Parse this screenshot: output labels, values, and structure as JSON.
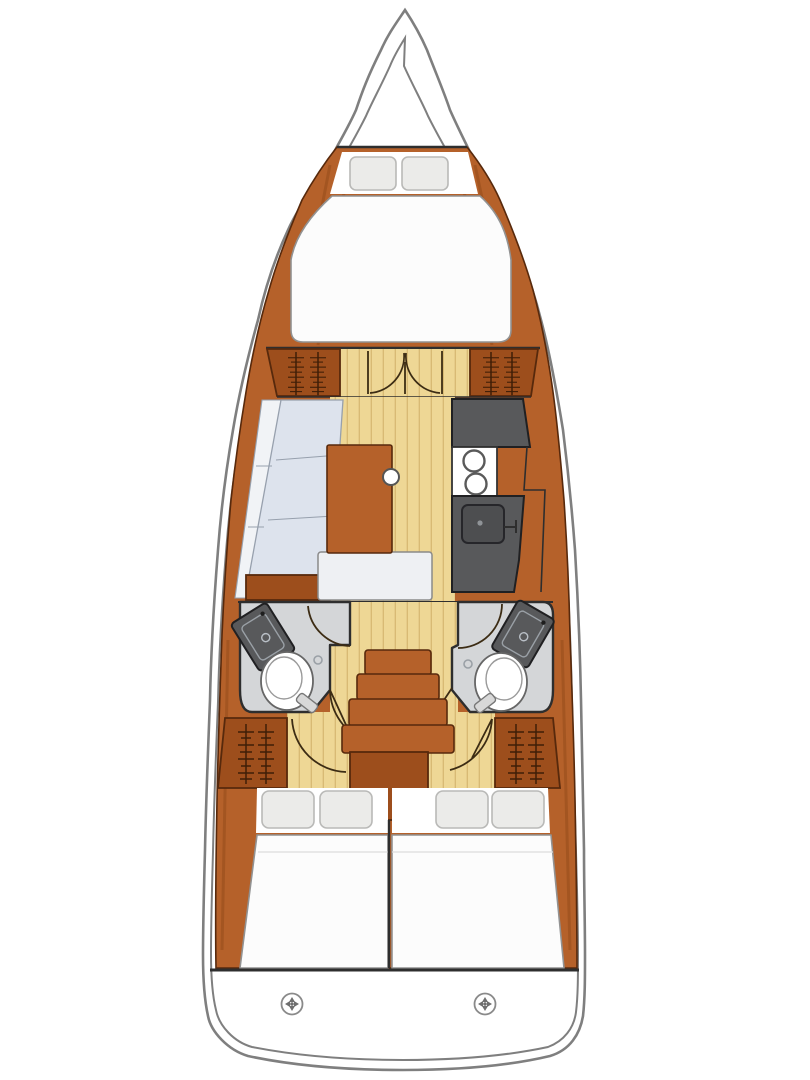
{
  "diagram": {
    "type": "sailboat-interior-floor-plan",
    "orientation": "bow-up",
    "regions": [
      "foredeck",
      "forward-cabin",
      "forward-v-berth",
      "forward-hanging-lockers",
      "forward-cabin-double-doors",
      "saloon",
      "port-settee",
      "saloon-table",
      "nav-seat",
      "galley",
      "galley-worktop",
      "stove",
      "galley-sink",
      "port-head",
      "starboard-head",
      "companionway-steps",
      "engine-compartment",
      "aft-hanging-lockers",
      "aft-cabin-port",
      "aft-cabin-starboard",
      "transom",
      "deck-fittings"
    ],
    "symbols": {
      "hanger_rod": "clothes-rod-with-hangers",
      "door_swing": "quarter-circle-arc",
      "deck_fitting": "circled-cross-cap",
      "burner": "circle",
      "toilet": "oval-bowl",
      "washbasin": "tilted-dark-rectangle"
    },
    "counts": {
      "cabins": 3,
      "heads": 2,
      "forward_pillows": 2,
      "aft_pillows_port": 2,
      "aft_pillows_starboard": 2,
      "stove_burners": 2,
      "companionway_steps": 4,
      "deck_fittings": 2
    }
  },
  "colors": {
    "hull_line": "#7f7f7f",
    "interior_line": "#2e2e2e",
    "wood": "#b5612a",
    "wood_dark": "#9d4e1c",
    "wood_edge": "#57290c",
    "wood_streak": "#8a4315",
    "hanger": "#3f1e07",
    "door_line": "#3c2c14",
    "floor": "#eed795",
    "floor_line": "#d8ba74",
    "berth": "#fcfcfc",
    "berth_line": "#929292",
    "pillow": "#ebebe9",
    "pillow_line": "#b9b9b7",
    "settee": "#dde3ed",
    "settee_line": "#97a0ad",
    "settee_back": "#f1f3f6",
    "counter": "#58595b",
    "counter_line": "#202022",
    "head_floor": "#d4d6d8",
    "fixture_white": "#ffffff"
  }
}
